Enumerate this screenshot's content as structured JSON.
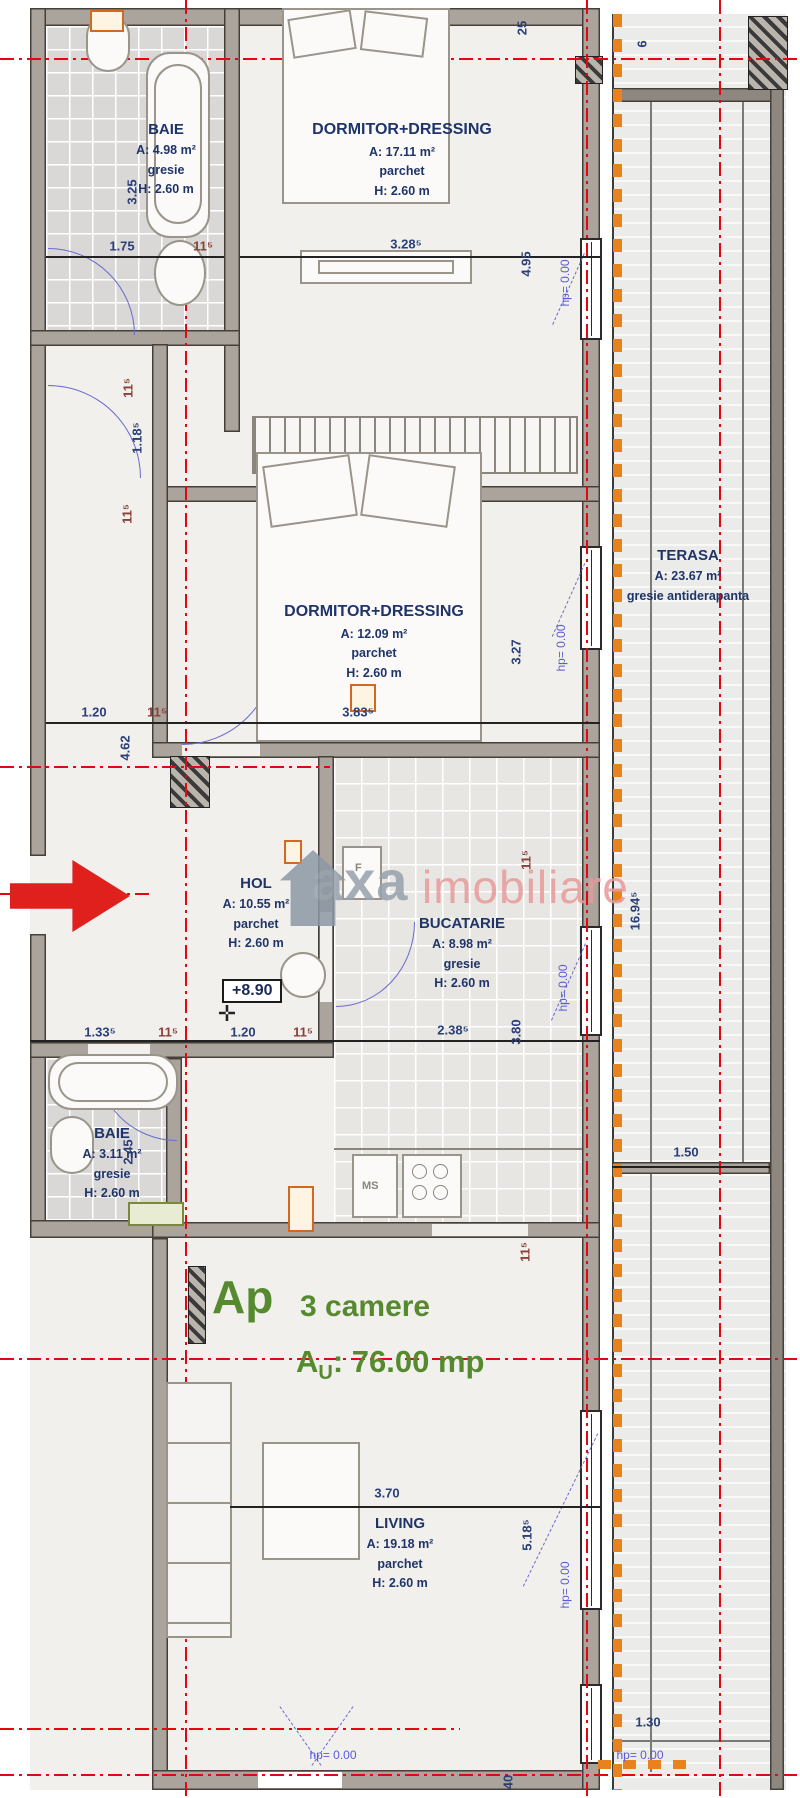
{
  "title": {
    "ap": "Ap",
    "rooms_count": "3 camere",
    "area_a": "A",
    "area_sub": "U",
    "area_rest": ": 76.00 mp"
  },
  "watermark": {
    "first": "axa",
    "second": "imobiliare"
  },
  "level_marker": "+8.90",
  "icons": {
    "survey_point": "✛"
  },
  "rooms": {
    "baie_top": {
      "name": "BAIE",
      "area": "A: 4.98 m²",
      "floor": "gresie",
      "height": "H: 2.60 m"
    },
    "dormitor_top": {
      "name": "DORMITOR+DRESSING",
      "area": "A: 17.11 m²",
      "floor": "parchet",
      "height": "H: 2.60 m"
    },
    "dormitor_mid": {
      "name": "DORMITOR+DRESSING",
      "area": "A: 12.09 m²",
      "floor": "parchet",
      "height": "H: 2.60 m"
    },
    "terasa": {
      "name": "TERASA",
      "area": "A: 23.67 m²",
      "floor": "gresie antiderapanta"
    },
    "hol": {
      "name": "HOL",
      "area": "A: 10.55 m²",
      "floor": "parchet",
      "height": "H: 2.60 m"
    },
    "bucatarie": {
      "name": "BUCATARIE",
      "area": "A: 8.98 m²",
      "floor": "gresie",
      "height": "H: 2.60 m"
    },
    "baie_bottom": {
      "name": "BAIE",
      "area": "A: 3.11 m²",
      "floor": "gresie",
      "height": "H: 2.60 m"
    },
    "living": {
      "name": "LIVING",
      "area": "A: 19.18 m²",
      "floor": "parchet",
      "height": "H: 2.60 m"
    }
  },
  "annotations": {
    "fridge": "F",
    "ms": "MS"
  },
  "dims": {
    "d1": "3.25",
    "d2": "1.75",
    "d3": "11⁵",
    "d4": "3.28⁵",
    "d5": "4.95",
    "d6": "25",
    "d7": "6",
    "d8": "11⁵",
    "d9": "1.18⁵",
    "d10": "11⁵",
    "d11": "1.20",
    "d12": "11⁵",
    "d13": "4.62",
    "d14": "3.83⁵",
    "d15": "3.27",
    "d16": "11⁵",
    "d17": "16.94⁵",
    "d18": "1.33⁵",
    "d19": "11⁵",
    "d20": "1.20",
    "d21": "11⁵",
    "d22": "2.38⁵",
    "d23": "3.80",
    "d24": "2.45",
    "d25": "1.50",
    "d26": "11⁵",
    "d27": "3.70",
    "d28": "5.18⁵",
    "d29": "1.30",
    "d30": "40"
  },
  "hp": {
    "h1": "hp= 0.00",
    "h2": "hp= 0.00",
    "h3": "hp= 0.00",
    "h4": "hp= 0.00",
    "h5": "hp= 0.00",
    "h6": "hp= 0.00"
  },
  "colors": {
    "accent_green": "#568a2e",
    "axis_red": "#e30613",
    "insulation_orange": "#e8821e",
    "door_blue": "#6a6ad0",
    "label_navy": "#1f3468",
    "wall_gray": "#aaa49c"
  }
}
